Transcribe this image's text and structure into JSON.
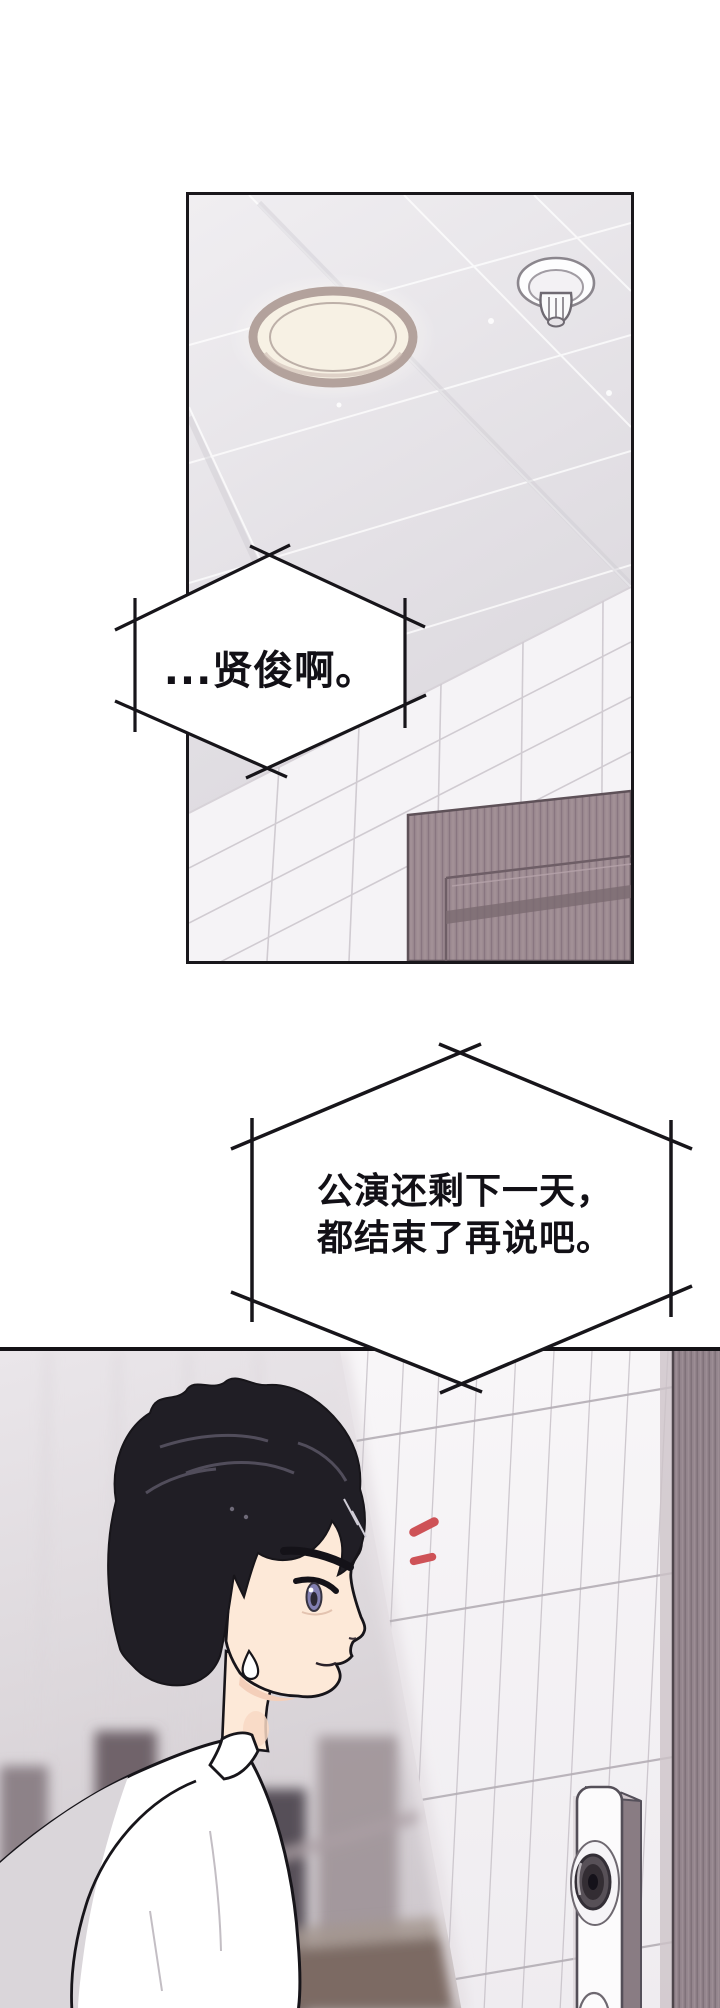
{
  "page": {
    "media_type": "webtoon-comic-page",
    "background": "#ffffff",
    "panel_count": 2
  },
  "speech_bubble_1": {
    "shape": "hexagon-crossed-lines",
    "text": "...贤俊啊。"
  },
  "speech_bubble_2": {
    "shape": "hexagon-crossed-lines",
    "line1": "公演还剩下一天，",
    "line2": "都结束了再说吧。"
  },
  "panel_1": {
    "description": "corridor ceiling with round light fixture and fire sprinkler, tiled wall and wooden door below"
  },
  "panel_2": {
    "description": "black-haired young man in white shirt, profile view with sweat drop, facing a door with a video intercom"
  },
  "colors": {
    "panel_border": "#19171b",
    "ceiling": "#e7e4e8",
    "ceiling_grid": "#ffffff",
    "light_rim": "#b3a29c",
    "light_face": "#f7f1e4",
    "wall_tile": "#f5f3f6",
    "tile_grout": "#cdc7ce",
    "door_wood": "#9e8c92",
    "door_inset": "#6e5e66",
    "hair": "#201e25",
    "skin": "#fde9d8",
    "shirt": "#ffffff",
    "shirt_shade": "#dad6da",
    "eye_iris": "#8280b2",
    "emphasis_marks_red": "#ce5257",
    "corridor_blur": "#d8d3d7",
    "corridor_door_blur": "#5f565c",
    "door_frame": "#93848c",
    "intercom_body": "#fcfbfc",
    "intercom_lens": "#332d33"
  }
}
